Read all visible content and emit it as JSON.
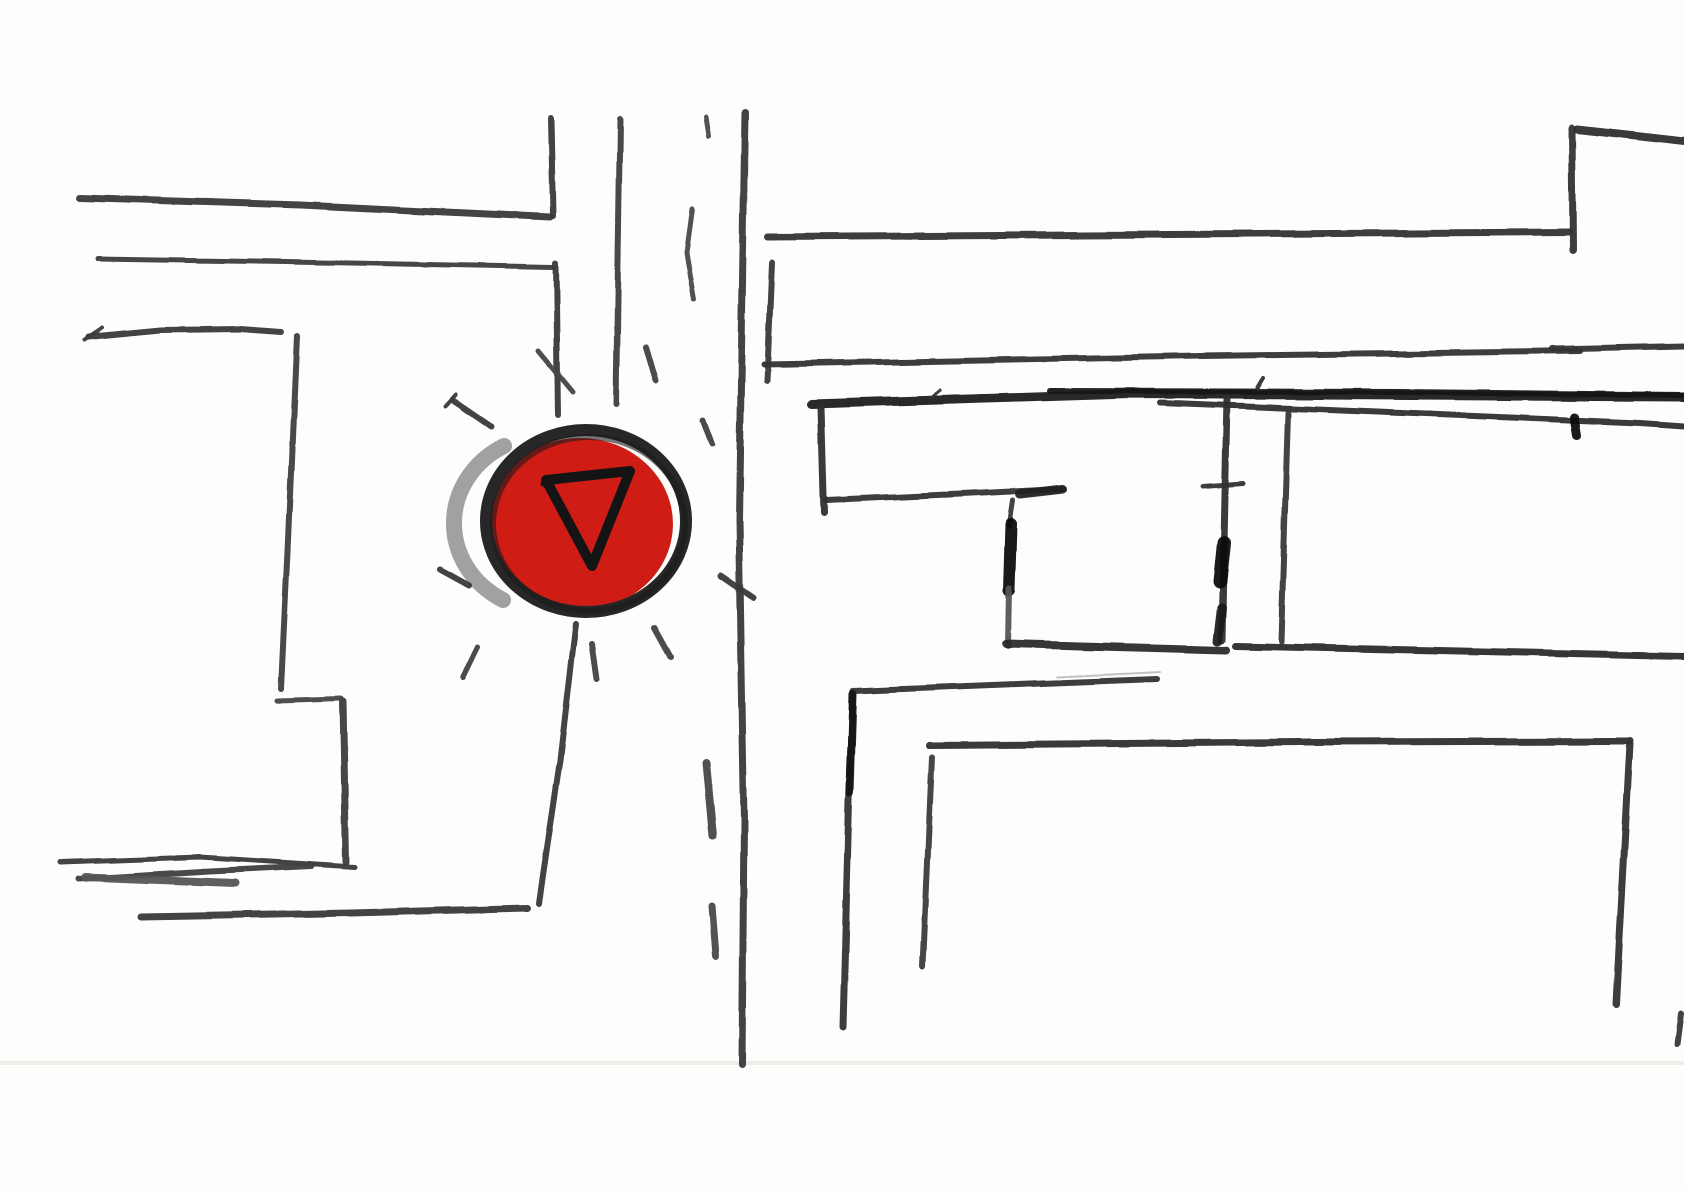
{
  "scene": {
    "type": "hand-drawn-street-map-sketch",
    "width": 1684,
    "height": 1190,
    "background": "#fdfdfc",
    "paper_crease": {
      "y": 1061,
      "height": 4,
      "color": "#e9ede4",
      "opacity": 0.9
    }
  },
  "marker": {
    "icon": "yield-triangle-icon",
    "red_fill": {
      "cx": 580,
      "cy": 524,
      "rx": 93,
      "ry": 86,
      "color": "#cf1d16"
    },
    "ring_outer": {
      "cx": 586,
      "cy": 521,
      "rx": 100,
      "ry": 91,
      "width": 12,
      "color": "#272727"
    },
    "ring_inner": {
      "cx": 589,
      "cy": 524,
      "rx": 96,
      "ry": 87,
      "width": 6,
      "color": "#1b1b1b",
      "opacity": 0.6
    },
    "smudge_arc": {
      "d": "M 504,446 A 96,88 0 0 0 503,600",
      "width": 16,
      "color": "#303030",
      "opacity": 0.45
    },
    "triangle": {
      "d": "M 546,480 L 630,471 L 592,566 Z",
      "width": 10,
      "color": "#141414"
    },
    "triangle_overlay": {
      "pts": [
        [
          543,
          484
        ],
        [
          606,
          473
        ]
      ],
      "width": 5,
      "color": "#141414"
    }
  },
  "strokes": [
    {
      "n": "road-left-edge-upper",
      "layer": "roads",
      "pts": [
        [
          551,
          118
        ],
        [
          553,
          216
        ]
      ],
      "w": 6,
      "c": "#3a3a3a"
    },
    {
      "n": "crossroad-top-line-1",
      "layer": "roads",
      "pts": [
        [
          80,
          198
        ],
        [
          300,
          205
        ],
        [
          550,
          217
        ]
      ],
      "w": 7,
      "c": "#383838"
    },
    {
      "n": "crossroad-top-line-2",
      "layer": "roads",
      "pts": [
        [
          97,
          259
        ],
        [
          350,
          263
        ],
        [
          554,
          267
        ]
      ],
      "w": 5,
      "c": "#3c3c3c"
    },
    {
      "n": "road-left-edge-mid",
      "layer": "roads",
      "pts": [
        [
          556,
          263
        ],
        [
          558,
          416
        ]
      ],
      "w": 6,
      "c": "#3a3a3a"
    },
    {
      "n": "road-left-edge-cross-dash",
      "layer": "roads",
      "pts": [
        [
          539,
          351
        ],
        [
          573,
          392
        ]
      ],
      "w": 5,
      "c": "#454545"
    },
    {
      "n": "road-center-line-upper",
      "layer": "roads",
      "pts": [
        [
          620,
          119
        ],
        [
          616,
          404
        ]
      ],
      "w": 6,
      "c": "#3f3f3f"
    },
    {
      "n": "road-right-edge",
      "layer": "roads",
      "pts": [
        [
          745,
          112
        ],
        [
          739,
          520
        ],
        [
          744,
          820
        ],
        [
          742,
          1065
        ]
      ],
      "w": 7,
      "c": "#383838"
    },
    {
      "n": "road-top-dash",
      "layer": "roads",
      "pts": [
        [
          706,
          117
        ],
        [
          709,
          136
        ]
      ],
      "w": 5,
      "c": "#4a4a4a"
    },
    {
      "n": "road-side-curved-dash",
      "layer": "roads",
      "pts": [
        [
          692,
          209
        ],
        [
          686,
          252
        ],
        [
          694,
          299
        ]
      ],
      "w": 5,
      "c": "#4a4a4a"
    },
    {
      "n": "road-left-edge-lower",
      "layer": "roads",
      "pts": [
        [
          576,
          624
        ],
        [
          560,
          760
        ],
        [
          539,
          903
        ]
      ],
      "w": 6,
      "c": "#3a3a3a"
    },
    {
      "n": "road-center-dash-1",
      "layer": "roads",
      "pts": [
        [
          706,
          763
        ],
        [
          713,
          836
        ]
      ],
      "w": 8,
      "c": "#474747"
    },
    {
      "n": "road-center-dash-2",
      "layer": "roads",
      "pts": [
        [
          712,
          906
        ],
        [
          716,
          956
        ]
      ],
      "w": 7,
      "c": "#4a4a4a"
    },
    {
      "n": "west-street-line",
      "layer": "roads",
      "pts": [
        [
          88,
          337
        ],
        [
          160,
          330
        ],
        [
          240,
          329
        ],
        [
          281,
          332
        ]
      ],
      "w": 6,
      "c": "#3a3a3a"
    },
    {
      "n": "west-street-arrow-tick",
      "layer": "roads",
      "pts": [
        [
          84,
          340
        ],
        [
          102,
          328
        ]
      ],
      "w": 4,
      "c": "#3a3a3a"
    },
    {
      "n": "west-vertical",
      "layer": "roads",
      "pts": [
        [
          297,
          336
        ],
        [
          288,
          540
        ],
        [
          281,
          689
        ]
      ],
      "w": 6,
      "c": "#3f3f3f"
    },
    {
      "n": "west-l-horizontal",
      "layer": "roads",
      "pts": [
        [
          277,
          701
        ],
        [
          341,
          699
        ]
      ],
      "w": 5,
      "c": "#444444"
    },
    {
      "n": "west-l-vertical",
      "layer": "roads",
      "pts": [
        [
          343,
          702
        ],
        [
          346,
          862
        ]
      ],
      "w": 7,
      "c": "#3d3d3d"
    },
    {
      "n": "southwest-line-1",
      "layer": "roads",
      "pts": [
        [
          60,
          862
        ],
        [
          200,
          857
        ],
        [
          355,
          867
        ]
      ],
      "w": 5,
      "c": "#3a3a3a"
    },
    {
      "n": "southwest-line-2",
      "layer": "roads",
      "pts": [
        [
          78,
          879
        ],
        [
          210,
          871
        ],
        [
          312,
          866
        ]
      ],
      "w": 6,
      "c": "#3f3f3f"
    },
    {
      "n": "southwest-line-3",
      "layer": "roads",
      "pts": [
        [
          85,
          877
        ],
        [
          235,
          883
        ]
      ],
      "w": 8,
      "c": "#555555"
    },
    {
      "n": "southwest-long-line",
      "layer": "roads",
      "pts": [
        [
          142,
          917
        ],
        [
          350,
          913
        ],
        [
          528,
          908
        ]
      ],
      "w": 7,
      "c": "#3a3a3a"
    },
    {
      "n": "east-top-line",
      "layer": "buildings",
      "pts": [
        [
          768,
          237
        ],
        [
          1569,
          232
        ]
      ],
      "w": 7,
      "c": "#343434"
    },
    {
      "n": "east-top-corner-vertical",
      "layer": "buildings",
      "pts": [
        [
          1573,
          250
        ],
        [
          1572,
          128
        ]
      ],
      "w": 7,
      "c": "#343434"
    },
    {
      "n": "northeast-edge-line",
      "layer": "buildings",
      "pts": [
        [
          1577,
          129
        ],
        [
          1684,
          141
        ]
      ],
      "w": 8,
      "c": "#2e2e2e"
    },
    {
      "n": "east-tick-vertical",
      "layer": "buildings",
      "pts": [
        [
          772,
          263
        ],
        [
          767,
          381
        ]
      ],
      "w": 6,
      "c": "#3a3a3a"
    },
    {
      "n": "east-line-b",
      "layer": "buildings",
      "pts": [
        [
          764,
          364
        ],
        [
          1200,
          356
        ],
        [
          1580,
          351
        ]
      ],
      "w": 6,
      "c": "#343434"
    },
    {
      "n": "east-line-b2",
      "layer": "buildings",
      "pts": [
        [
          1552,
          349
        ],
        [
          1684,
          346
        ]
      ],
      "w": 6,
      "c": "#343434"
    },
    {
      "n": "east-thick-line",
      "layer": "buildings",
      "pts": [
        [
          812,
          404
        ],
        [
          1130,
          394
        ],
        [
          1684,
          397
        ]
      ],
      "w": 9,
      "c": "#202020"
    },
    {
      "n": "east-thick-overlay",
      "layer": "buildings",
      "pts": [
        [
          1050,
          391
        ],
        [
          1400,
          392
        ],
        [
          1684,
          395
        ]
      ],
      "w": 6,
      "c": "#161616"
    },
    {
      "n": "east-thick-lower-split",
      "layer": "buildings",
      "pts": [
        [
          1160,
          403
        ],
        [
          1450,
          415
        ],
        [
          1640,
          423
        ],
        [
          1684,
          426
        ]
      ],
      "w": 6,
      "c": "#2e2e2e"
    },
    {
      "n": "east-thick-nub",
      "layer": "buildings",
      "pts": [
        [
          1574,
          417
        ],
        [
          1577,
          435
        ]
      ],
      "w": 9,
      "c": "#101010"
    },
    {
      "n": "east-thick-tick-1",
      "layer": "buildings",
      "pts": [
        [
          930,
          398
        ],
        [
          940,
          390
        ]
      ],
      "w": 3,
      "c": "#333333"
    },
    {
      "n": "east-thick-tick-2",
      "layer": "buildings",
      "pts": [
        [
          1257,
          388
        ],
        [
          1263,
          378
        ]
      ],
      "w": 4,
      "c": "#333333"
    },
    {
      "n": "boxa-left-vertical",
      "layer": "buildings",
      "pts": [
        [
          821,
          407
        ],
        [
          824,
          513
        ]
      ],
      "w": 7,
      "c": "#2f2f2f"
    },
    {
      "n": "boxa-bottom-line",
      "layer": "buildings",
      "pts": [
        [
          826,
          500
        ],
        [
          960,
          494
        ],
        [
          1064,
          489
        ]
      ],
      "w": 6,
      "c": "#333333"
    },
    {
      "n": "boxa-bottom-wedge",
      "layer": "buildings",
      "pts": [
        [
          1020,
          494
        ],
        [
          1063,
          489
        ]
      ],
      "w": 9,
      "c": "#222222"
    },
    {
      "n": "boxa-right-vertical-top",
      "layer": "buildings",
      "pts": [
        [
          1013,
          500
        ],
        [
          1009,
          527
        ]
      ],
      "w": 5,
      "c": "#3a3a3a"
    },
    {
      "n": "boxa-right-vertical-black",
      "layer": "buildings",
      "pts": [
        [
          1011,
          524
        ],
        [
          1009,
          590
        ]
      ],
      "w": 12,
      "c": "#0d0d0d"
    },
    {
      "n": "boxa-right-vertical-low",
      "layer": "buildings",
      "pts": [
        [
          1009,
          588
        ],
        [
          1008,
          646
        ]
      ],
      "w": 6,
      "c": "#555555"
    },
    {
      "n": "boxa-bottom-line-2",
      "layer": "buildings",
      "pts": [
        [
          1006,
          644
        ],
        [
          1226,
          650
        ]
      ],
      "w": 8,
      "c": "#2a2a2a"
    },
    {
      "n": "mid-vertical-1",
      "layer": "buildings",
      "pts": [
        [
          1227,
          399
        ],
        [
          1222,
          640
        ]
      ],
      "w": 7,
      "c": "#2f2f2f"
    },
    {
      "n": "mid-vertical-1-blob",
      "layer": "buildings",
      "pts": [
        [
          1224,
          543
        ],
        [
          1220,
          582
        ]
      ],
      "w": 14,
      "c": "#101010"
    },
    {
      "n": "mid-vertical-1-tick",
      "layer": "buildings",
      "pts": [
        [
          1203,
          486
        ],
        [
          1243,
          483
        ]
      ],
      "w": 5,
      "c": "#333333"
    },
    {
      "n": "mid-vertical-1-foot",
      "layer": "buildings",
      "pts": [
        [
          1222,
          608
        ],
        [
          1218,
          641
        ]
      ],
      "w": 9,
      "c": "#1c1c1c"
    },
    {
      "n": "mid-vertical-2",
      "layer": "buildings",
      "pts": [
        [
          1288,
          413
        ],
        [
          1281,
          641
        ]
      ],
      "w": 6,
      "c": "#383838"
    },
    {
      "n": "east-low-line",
      "layer": "buildings",
      "pts": [
        [
          1235,
          646
        ],
        [
          1684,
          656
        ]
      ],
      "w": 7,
      "c": "#2c2c2c"
    },
    {
      "n": "faint-line",
      "layer": "buildings",
      "pts": [
        [
          1058,
          677
        ],
        [
          1160,
          672
        ]
      ],
      "w": 2,
      "c": "#9a9a9a",
      "o": 0.6
    },
    {
      "n": "south-building-top",
      "layer": "buildings",
      "pts": [
        [
          853,
          691
        ],
        [
          1157,
          679
        ]
      ],
      "w": 6,
      "c": "#333333"
    },
    {
      "n": "south-building-left",
      "layer": "buildings",
      "pts": [
        [
          853,
          693
        ],
        [
          849,
          800
        ],
        [
          843,
          1028
        ]
      ],
      "w": 7,
      "c": "#343434"
    },
    {
      "n": "south-building-left-dark",
      "layer": "buildings",
      "pts": [
        [
          853,
          694
        ],
        [
          850,
          792
        ]
      ],
      "w": 8,
      "c": "#181818"
    },
    {
      "n": "south-line-745",
      "layer": "buildings",
      "pts": [
        [
          929,
          745
        ],
        [
          1300,
          742
        ],
        [
          1630,
          741
        ]
      ],
      "w": 7,
      "c": "#2e2e2e"
    },
    {
      "n": "south-vertical-930",
      "layer": "buildings",
      "pts": [
        [
          932,
          757
        ],
        [
          923,
          967
        ]
      ],
      "w": 6,
      "c": "#3d3d3d"
    },
    {
      "n": "southeast-vertical",
      "layer": "buildings",
      "pts": [
        [
          1630,
          744
        ],
        [
          1616,
          1004
        ]
      ],
      "w": 7,
      "c": "#333333"
    },
    {
      "n": "southeast-stray",
      "layer": "buildings",
      "pts": [
        [
          1681,
          1013
        ],
        [
          1677,
          1044
        ]
      ],
      "w": 6,
      "c": "#3a3a3a"
    },
    {
      "n": "burst-up-left",
      "layer": "burst",
      "pts": [
        [
          453,
          401
        ],
        [
          491,
          427
        ]
      ],
      "w": 6,
      "c": "#3a3a3a"
    },
    {
      "n": "burst-up-left-tick",
      "layer": "burst",
      "pts": [
        [
          445,
          407
        ],
        [
          456,
          395
        ]
      ],
      "w": 4,
      "c": "#3a3a3a"
    },
    {
      "n": "burst-up",
      "layer": "burst",
      "pts": [
        [
          646,
          347
        ],
        [
          656,
          381
        ]
      ],
      "w": 6,
      "c": "#414141"
    },
    {
      "n": "burst-up-right",
      "layer": "burst",
      "pts": [
        [
          703,
          420
        ],
        [
          712,
          444
        ]
      ],
      "w": 6,
      "c": "#414141"
    },
    {
      "n": "burst-right",
      "layer": "burst",
      "pts": [
        [
          721,
          576
        ],
        [
          753,
          598
        ]
      ],
      "w": 6,
      "c": "#3a3a3a"
    },
    {
      "n": "burst-down-right",
      "layer": "burst",
      "pts": [
        [
          655,
          628
        ],
        [
          671,
          657
        ]
      ],
      "w": 6,
      "c": "#414141"
    },
    {
      "n": "burst-down",
      "layer": "burst",
      "pts": [
        [
          592,
          645
        ],
        [
          597,
          679
        ]
      ],
      "w": 6,
      "c": "#414141"
    },
    {
      "n": "burst-down-left",
      "layer": "burst",
      "pts": [
        [
          477,
          646
        ],
        [
          462,
          677
        ]
      ],
      "w": 5,
      "c": "#414141"
    },
    {
      "n": "burst-left",
      "layer": "burst",
      "pts": [
        [
          440,
          569
        ],
        [
          469,
          585
        ]
      ],
      "w": 6,
      "c": "#3a3a3a"
    }
  ]
}
